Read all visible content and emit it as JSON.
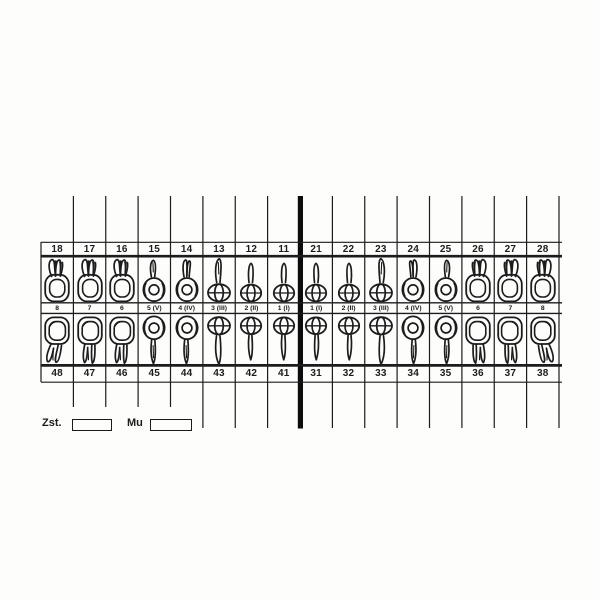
{
  "document": {
    "kind": "dental-chart-odontogram",
    "notation": "FDI"
  },
  "teeth": [
    {
      "upper": "18",
      "label": "8",
      "lower": "48",
      "upper_glyph": "molar-upper",
      "lower_glyph": "molar-lower-hook",
      "mirror": false
    },
    {
      "upper": "17",
      "label": "7",
      "lower": "47",
      "upper_glyph": "molar-upper",
      "lower_glyph": "molar-lower",
      "mirror": false
    },
    {
      "upper": "16",
      "label": "6",
      "lower": "46",
      "upper_glyph": "molar-upper",
      "lower_glyph": "molar-lower",
      "mirror": false
    },
    {
      "upper": "15",
      "label": "5 (V)",
      "lower": "45",
      "upper_glyph": "premolar1-upper",
      "lower_glyph": "premolar-lower",
      "mirror": false
    },
    {
      "upper": "14",
      "label": "4 (IV)",
      "lower": "44",
      "upper_glyph": "premolar2-upper",
      "lower_glyph": "premolar-lower",
      "mirror": false
    },
    {
      "upper": "13",
      "label": "3 (III)",
      "lower": "43",
      "upper_glyph": "canine-upper",
      "lower_glyph": "canine-lower",
      "mirror": false
    },
    {
      "upper": "12",
      "label": "2 (II)",
      "lower": "42",
      "upper_glyph": "incisor-upper",
      "lower_glyph": "incisor-lower",
      "mirror": false
    },
    {
      "upper": "11",
      "label": "1 (I)",
      "lower": "41",
      "upper_glyph": "incisor-upper",
      "lower_glyph": "incisor-lower",
      "mirror": false
    },
    {
      "upper": "21",
      "label": "1 (I)",
      "lower": "31",
      "upper_glyph": "incisor-upper",
      "lower_glyph": "incisor-lower",
      "mirror": true
    },
    {
      "upper": "22",
      "label": "2 (II)",
      "lower": "32",
      "upper_glyph": "incisor-upper",
      "lower_glyph": "incisor-lower",
      "mirror": true
    },
    {
      "upper": "23",
      "label": "3 (III)",
      "lower": "33",
      "upper_glyph": "canine-upper",
      "lower_glyph": "canine-lower",
      "mirror": true
    },
    {
      "upper": "24",
      "label": "4 (IV)",
      "lower": "34",
      "upper_glyph": "premolar2-upper",
      "lower_glyph": "premolar-lower",
      "mirror": true
    },
    {
      "upper": "25",
      "label": "5 (V)",
      "lower": "35",
      "upper_glyph": "premolar1-upper",
      "lower_glyph": "premolar-lower",
      "mirror": true
    },
    {
      "upper": "26",
      "label": "6",
      "lower": "36",
      "upper_glyph": "molar-upper",
      "lower_glyph": "molar-lower",
      "mirror": true
    },
    {
      "upper": "27",
      "label": "7",
      "lower": "37",
      "upper_glyph": "molar-upper",
      "lower_glyph": "molar-lower",
      "mirror": true
    },
    {
      "upper": "28",
      "label": "8",
      "lower": "38",
      "upper_glyph": "molar-upper",
      "lower_glyph": "molar-lower-hook",
      "mirror": true
    }
  ],
  "footer": {
    "zst_label": "Zst.",
    "mu_label": "Mu"
  },
  "colors": {
    "ink": "#1c1c1c",
    "background": "#fdfdfc"
  }
}
